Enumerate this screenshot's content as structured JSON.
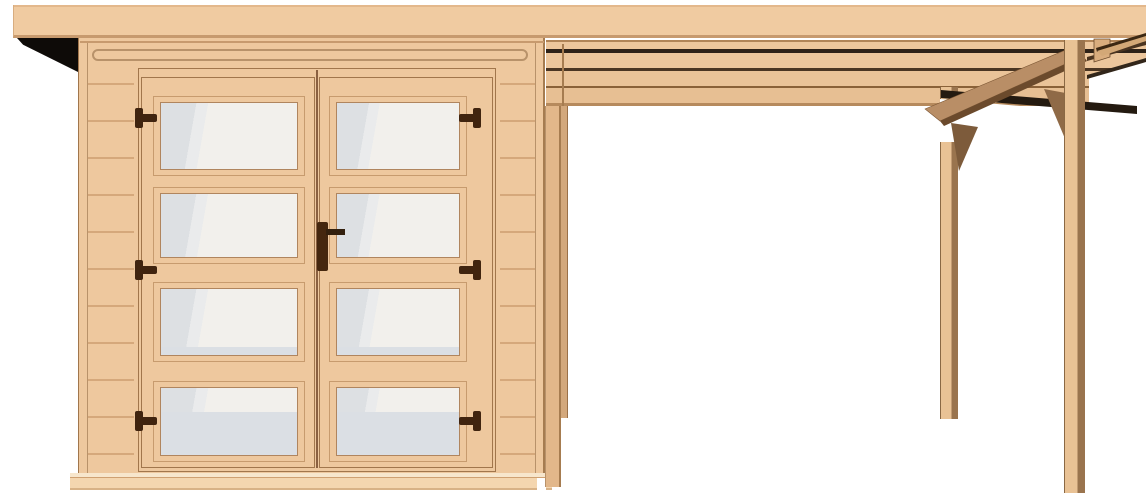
{
  "scene": {
    "type": "3d-product-rendering",
    "subject": "flat-roof garden shed with glazed double door and attached side canopy on timber posts",
    "background": "#ffffff",
    "width_px": 1146,
    "height_px": 496
  },
  "palette": {
    "bg": "#ffffff",
    "wall": "#eec89e",
    "roof": "#f0cba1",
    "roof_edge": "#c79a6e",
    "line_soft": "#d5a87b",
    "line_mid": "#b8926a",
    "line_dark": "#9a7048",
    "door_line": "#a1764c",
    "black": "#0e0b08",
    "glass_light": "#f2f0ec",
    "glass_shade": "#dde0e3",
    "glass_cool": "#dbdfe4",
    "hardware": "#40240f",
    "pane_border": "#b0855e",
    "pane_frame": "#c79b6e",
    "beam_line": "#b08457",
    "beam1": "#ecc69c",
    "beam2": "#eac398",
    "beam3": "#e7bf93",
    "gap_dark": "#2e2218",
    "gap_mid": "#4a3522",
    "gap_brown": "#8a6138",
    "beam_edge": "#b68a5d",
    "fascia": "#b98e66",
    "fascia_shade": "#6b4a2c",
    "brace": "#8f6a47",
    "brace2": "#7d5b3b",
    "shadow_band": "#241a10",
    "corner_line": "#4a3420",
    "corner_line2": "#32261a",
    "piece_a": "#d9ad7e",
    "sliver": "#d3a877",
    "sliver_edge": "#3c2813",
    "post_face": "#e9c295",
    "post_side": "#9a744e",
    "post_side_l": "#a67c50",
    "post_lf": "#e2b78a",
    "post_lr": "#d3a87c",
    "base": "#f4d6af",
    "base_light": "#f7e6cc",
    "base_edge": "#cfa071"
  },
  "shed": {
    "roof": "flat overhanging roof slab with dark underside shadow at left",
    "siding": "horizontal plank lines on wall strips beside the door",
    "fascia_trim": "rounded-end trim board under roof edge",
    "door": {
      "type": "double door",
      "glass_panes_per_leaf": 4,
      "hinges_per_leaf": 3,
      "handle": "dark brown lever handle on right leaf center stile"
    },
    "base": "foundation plank strip below wall"
  },
  "canopy": {
    "attached_side": "right",
    "beams_visible": 3,
    "dark_gaps_between_beams": 2,
    "posts_visible": 4,
    "knee_braces_visible": 2,
    "fascia": "angled side fascia board receding to the right"
  }
}
